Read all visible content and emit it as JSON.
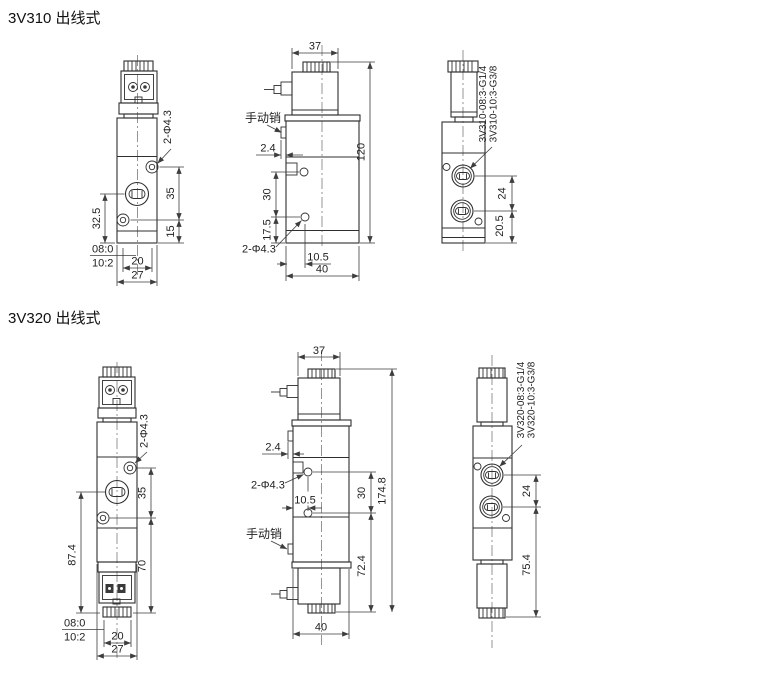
{
  "page": {
    "background": "#ffffff",
    "outline_color": "#2f2f2f",
    "dimension_color": "#3d3d3d",
    "centerline_color": "#7a7a7a"
  },
  "sections": [
    {
      "id": "3V310",
      "title": "3V310 出线式",
      "front": {
        "hole_note": "2-Φ4.3",
        "dim_hole_spacing": "35",
        "dim_lower": "15",
        "dim_port_bottom": "32.5",
        "thread_top": "08:0",
        "thread_bottom": "10:2",
        "dim_hole_pitch": "20",
        "dim_width": "27"
      },
      "side": {
        "dim_top_width": "37",
        "dim_height": "120",
        "manual_pin": "手动销",
        "dim_pin": "2.4",
        "dim_hole_v": "30",
        "dim_hole_bottom": "17.5",
        "hole_note": "2-Φ4.3",
        "dim_hole_x": "10.5",
        "dim_depth": "40"
      },
      "back": {
        "model_g14": "3V310-08:3-G1/4",
        "model_g38": "3V310-10:3-G3/8",
        "dim_port_pitch": "24",
        "dim_port_bottom": "20.5"
      }
    },
    {
      "id": "3V320",
      "title": "3V320 出线式",
      "front": {
        "hole_note": "2-Φ4.3",
        "dim_hole_spacing": "35",
        "dim_lower": "70",
        "dim_port_bottom": "87.4",
        "thread_top": "08:0",
        "thread_bottom": "10:2",
        "dim_hole_pitch": "20",
        "dim_width": "27"
      },
      "side": {
        "dim_top_width": "37",
        "dim_height": "174.8",
        "manual_pin": "手动销",
        "dim_pin": "2.4",
        "dim_hole_v": "30",
        "dim_hole_bottom": "72.4",
        "hole_note": "2-Φ4.3",
        "dim_hole_x": "10.5",
        "dim_depth": "40"
      },
      "back": {
        "model_g14": "3V320-08:3-G1/4",
        "model_g38": "3V320-10:3-G3/8",
        "dim_port_pitch": "24",
        "dim_port_bottom": "75.4"
      }
    }
  ]
}
